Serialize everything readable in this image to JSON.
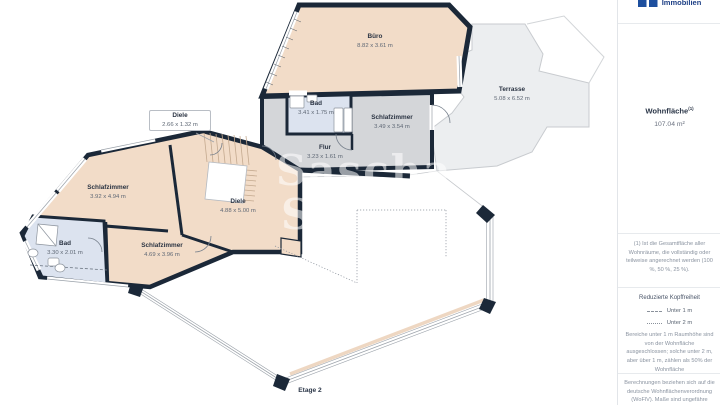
{
  "meta": {
    "floor_label": "Etage 2"
  },
  "brand": {
    "name": "Immobilien",
    "logo_color": "#1d4f9e"
  },
  "watermark": {
    "line1": "Sascha",
    "line2": "S"
  },
  "plan": {
    "colors": {
      "wall": "#1b2838",
      "floor_main": "#f2dcc8",
      "floor_secondary": "#d4d6d9",
      "floor_bath": "#dce3ef",
      "terrace": "#eceef0"
    },
    "rooms": [
      {
        "name": "Büro",
        "dims": "8.82 x 3.61 m"
      },
      {
        "name": "Terrasse",
        "dims": "5.08 x 6.52 m"
      },
      {
        "name": "Bad",
        "dims": "3.41 x 1.75 m"
      },
      {
        "name": "Schlafzimmer",
        "dims": "3.49 x 3.54 m"
      },
      {
        "name": "Flur",
        "dims": "3.23 x 1.61 m"
      },
      {
        "name": "Diele",
        "dims": "2.66 x 1.32 m"
      },
      {
        "name": "Diele",
        "dims": "4.88 x 5.00 m"
      },
      {
        "name": "Schlafzimmer",
        "dims": "3.92 x 4.94 m"
      },
      {
        "name": "Bad",
        "dims": "3.30 x 2.01 m"
      },
      {
        "name": "Schlafzimmer",
        "dims": "4.69 x 3.96 m"
      }
    ]
  },
  "sidebar": {
    "area_title": "Wohnfläche",
    "area_sup": "(1)",
    "area_value": "107.04 m²",
    "footnote": "(1) Ist die Gesamtfläche aller Wohnräume, die vollständig oder teilweise angerechnet werden (100 %, 50 %, 25 %).",
    "headroom_title": "Reduzierte Kopffreiheit",
    "legend": [
      {
        "label": "Unter 1 m"
      },
      {
        "label": "Unter 2 m"
      }
    ],
    "headroom_text": "Bereiche unter 1 m Raumhöhe sind von der Wohnfläche ausgeschlossen; solche unter 2 m, aber über 1 m, zählen als 50% der Wohnfläche",
    "calc_text": "Berechnungen beziehen sich auf die deutsche Wohnflächenverordnung (WoFlV). Maße sind ungefähre Angaben"
  }
}
